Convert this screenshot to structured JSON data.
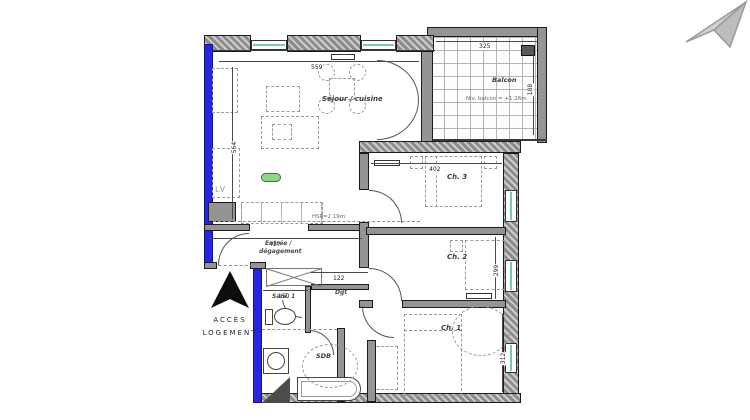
{
  "icons": {
    "corner": "paper-plane-icon",
    "access_arrow": "up-arrow-icon",
    "unit_badge": "green-pill-badge"
  },
  "colors": {
    "wall_blue": "#2626df",
    "wall_gray": "#949494",
    "glazing_teal": "#7ac9b5",
    "badge_green": "#8fd487",
    "watermark_gray": "#c6c6c6"
  },
  "rooms": {
    "sejour": {
      "label": "Séjour / cuisine",
      "width_cm": "559",
      "height_cm": "564",
      "ceiling": "HSP=2.19m"
    },
    "balcon": {
      "label": "Balcon",
      "width_cm": "325",
      "height_cm": "188",
      "level": "Niv. balcon = +1.26m"
    },
    "ch3": {
      "label": "Ch. 3",
      "width_cm": "402"
    },
    "ch2": {
      "label": "Ch. 2",
      "height_cm": "299"
    },
    "ch1": {
      "label": "Ch. 1",
      "height_cm": "312"
    },
    "entree": {
      "label_line1": "Entrée /",
      "label_line2": "dégagement",
      "width_cm": "427"
    },
    "dgt": {
      "label": "Dgt",
      "width_cm": "122"
    },
    "sani": {
      "label": "Sani. 1",
      "width_cm": "150"
    },
    "sdb": {
      "label": "SDB"
    }
  },
  "annotations": {
    "lv": "LV",
    "acces_line1": "ACCÈS",
    "acces_line2": "LOGEMENT"
  }
}
